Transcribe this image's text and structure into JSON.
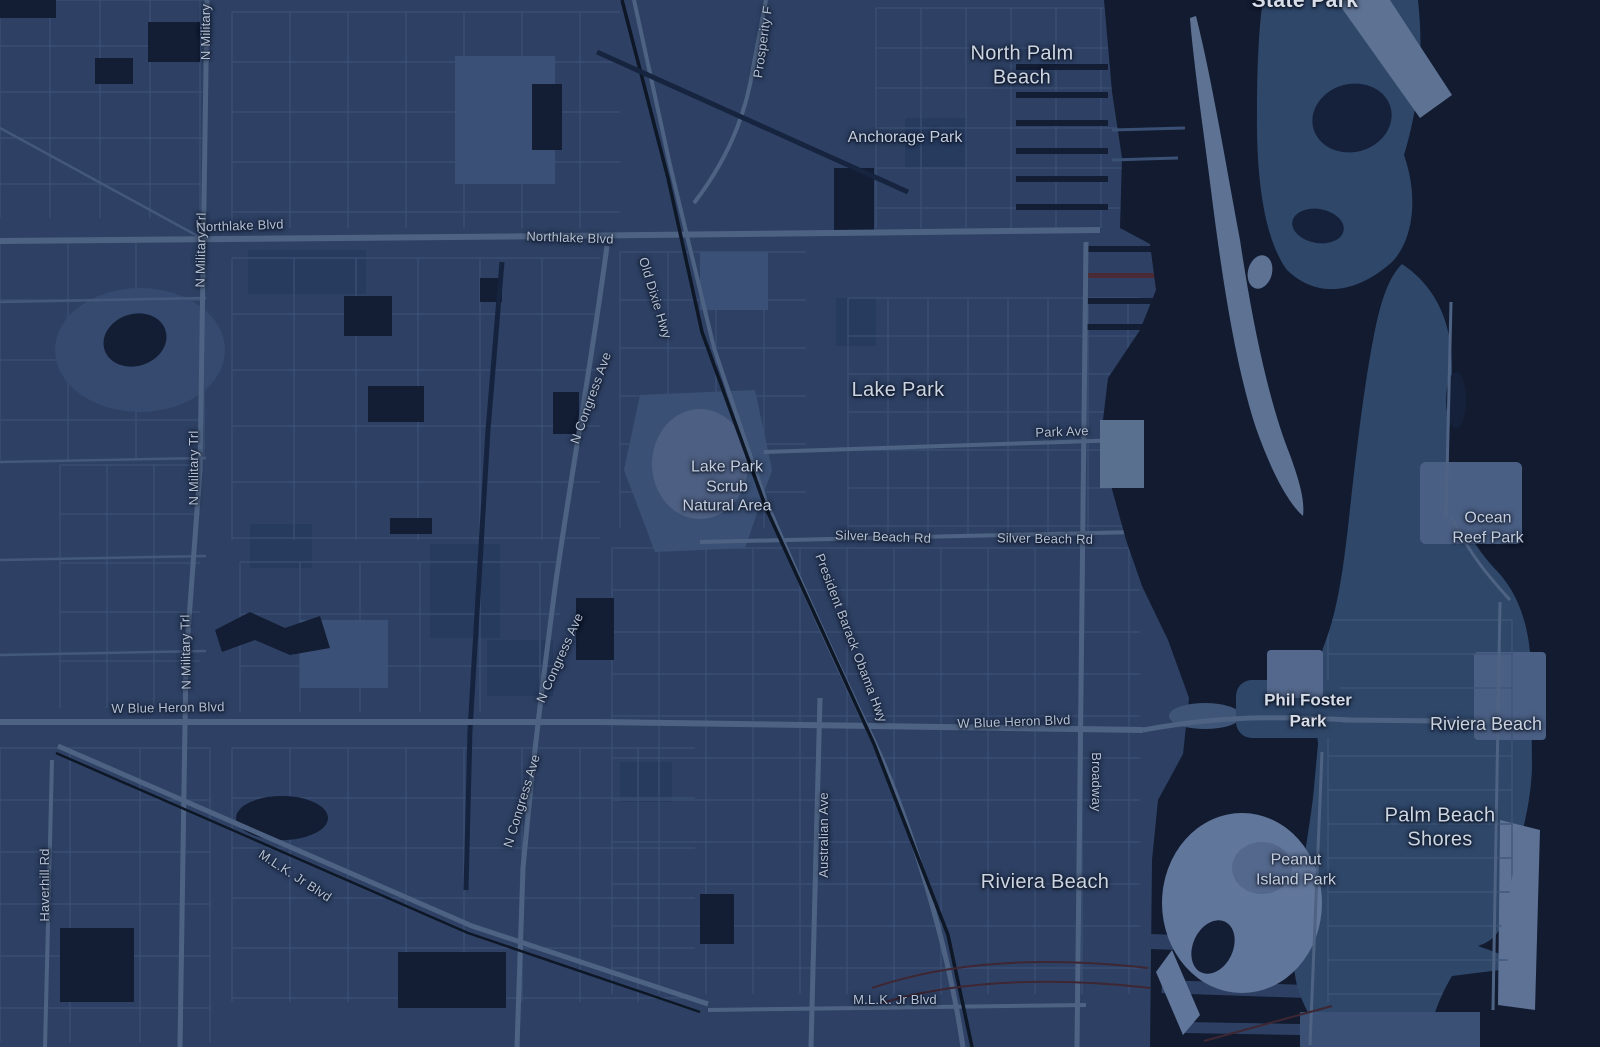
{
  "map": {
    "city_labels": [
      "North Palm\nBeach",
      "Lake Park",
      "Riviera Beach",
      "Palm Beach\nShores"
    ],
    "neighborhood_labels": [
      "Riviera Beach"
    ],
    "park_labels": [
      "State Park",
      "Anchorage Park",
      "Lake Park\nScrub\nNatural Area",
      "Ocean\nReef Park",
      "Phil Foster\nPark",
      "Peanut\nIsland Park"
    ],
    "road_labels": [
      "Prosperity F",
      "N Military",
      "N Military Trl",
      "N Military Trl",
      "N Military Trl",
      "Northlake Blvd",
      "Northlake Blvd",
      "Old Dixie Hwy",
      "N Congress Ave",
      "N Congress Ave",
      "N Congress Ave",
      "Park Ave",
      "Silver Beach Rd",
      "Silver Beach Rd",
      "President Barack Obama Hwy",
      "W Blue Heron Blvd",
      "W Blue Heron Blvd",
      "Broadway",
      "Australian Ave",
      "M.L.K. Jr Blvd",
      "M.L.K. Jr Blvd",
      "Haverhill Rd"
    ]
  },
  "colors": {
    "water": "#121b30",
    "land": "#2e4164",
    "land_light": "#3a5076",
    "island_light": "#5e7394",
    "road_major": "#4e6383",
    "road_minor": "#3c5175",
    "railway": "#0e1726",
    "dark_parcel": "#131d33",
    "label_city": "#ccd5e2",
    "label_road": "#b3c1d6"
  }
}
